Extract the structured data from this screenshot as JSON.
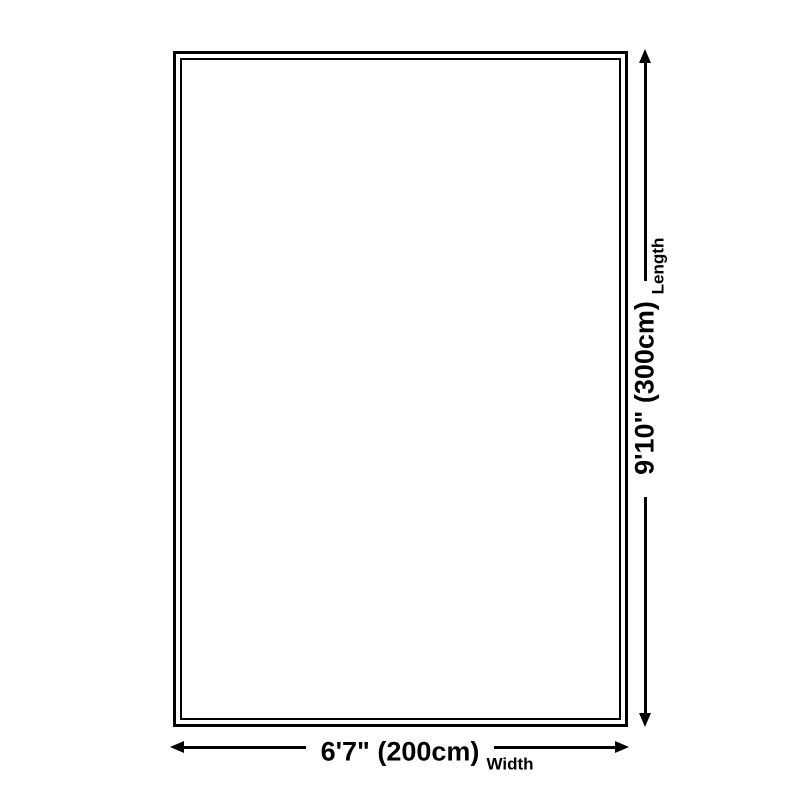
{
  "diagram": {
    "background_color": "#ffffff",
    "line_color": "#000000",
    "product": {
      "shape": "rectangle",
      "fill_color": "#ffffff",
      "border_color": "#000000",
      "border_style": "double"
    },
    "dimensions": {
      "length": {
        "value": "9'10\" (300cm)",
        "label": "Length"
      },
      "width": {
        "value": "6'7\" (200cm)",
        "label": "Width"
      }
    }
  }
}
